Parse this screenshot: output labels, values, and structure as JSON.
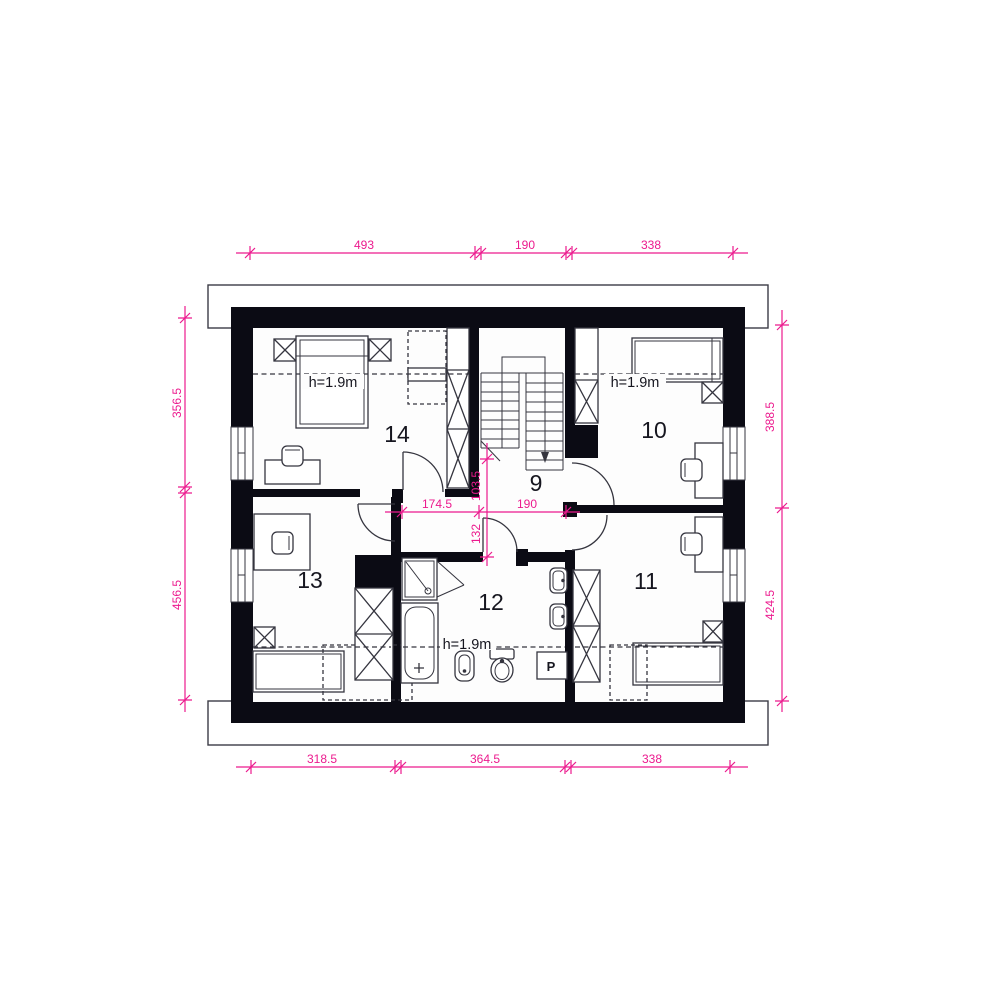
{
  "title": "attic floor plan",
  "rooms": {
    "r9": "9",
    "r10": "10",
    "r11": "11",
    "r12": "12",
    "r13": "13",
    "r14": "14"
  },
  "height_labels": {
    "room14": "h=1.9m",
    "room10": "h=1.9m",
    "room12": "h=1.9m"
  },
  "appliances": {
    "washer": "P"
  },
  "dimensions": {
    "top": [
      "493",
      "190",
      "338"
    ],
    "bottom": [
      "318.5",
      "364.5",
      "338"
    ],
    "left": [
      "356.5",
      "456.5"
    ],
    "right": [
      "388.5",
      "424.5"
    ],
    "interior": {
      "hall_left": "174.5",
      "hall_right": "190",
      "hall_depth": "103.5",
      "passage": "132"
    }
  },
  "colors": {
    "dimension": "#ec1a8e",
    "wall": "#0b0b14",
    "line": "#35353f"
  }
}
